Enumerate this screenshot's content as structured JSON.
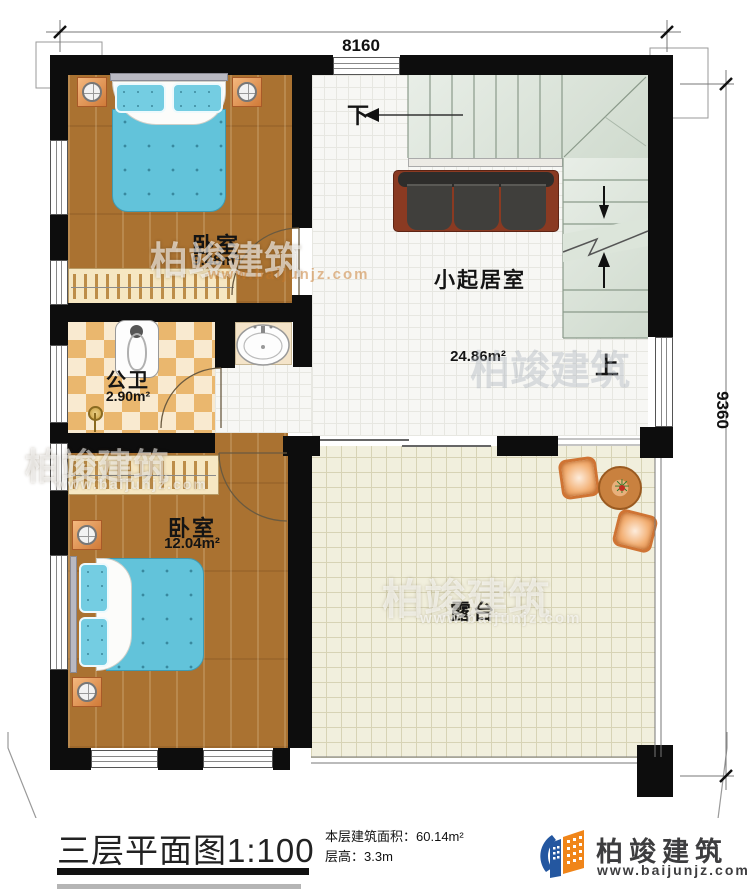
{
  "dimensions": {
    "width": "8160",
    "height": "9360"
  },
  "rooms": {
    "bedroom1": {
      "name": "卧室",
      "area": "9.48m²"
    },
    "living_room": {
      "name": "小起居室",
      "area": "24.86m²"
    },
    "bathroom": {
      "name": "公卫",
      "area": "2.90m²"
    },
    "bedroom2": {
      "name": "卧室",
      "area": "12.04m²"
    },
    "terrace": {
      "name": "露台"
    }
  },
  "stairs": {
    "down_label": "下",
    "up_label": "上"
  },
  "title_block": {
    "title": "三层平面图",
    "scale": "1:100",
    "floor_area_label": "本层建筑面积：",
    "floor_area_value": "60.14m²",
    "floor_height_label": "层高：",
    "floor_height_value": "3.3m"
  },
  "brand": {
    "name": "柏竣建筑",
    "website": "www.baijunjz.com"
  },
  "colors": {
    "wall": "#0d0d0d",
    "wood_floor": "#aa7231",
    "stair_floor": "#dce5da",
    "terrace_floor": "#f1efdd",
    "brand_orange": "#f08519",
    "brand_blue": "#2457a0"
  }
}
